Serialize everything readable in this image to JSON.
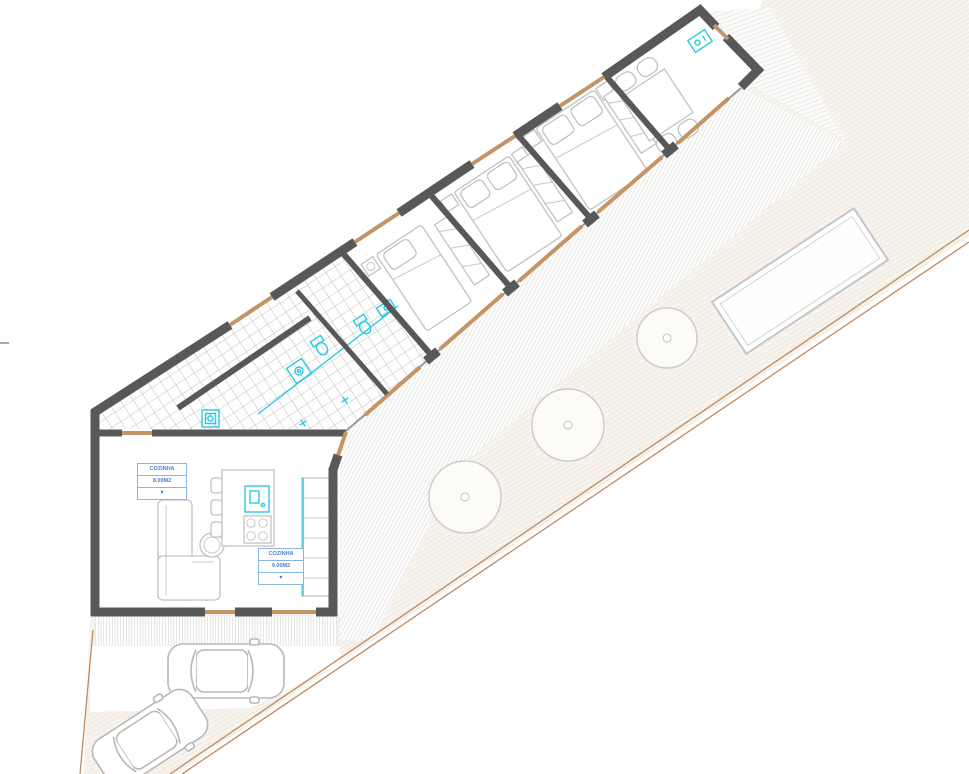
{
  "page": {
    "title": "Architectural site and floor plan"
  },
  "room_labels": {
    "label1": {
      "name": "COZINHA",
      "area": "8.00M2",
      "marker": "▼"
    },
    "label2": {
      "name": "COZINHA",
      "area": "9.00M2",
      "marker": "▼"
    }
  },
  "legend": {
    "wall_color": "#585858",
    "fixture_color": "#29cbe0",
    "threshold_color": "#c49465",
    "label_color": "#4a7fd0",
    "boundary_color": "#c08a5f"
  },
  "site": {
    "bedrooms": 3,
    "bathrooms": 2,
    "trees": 3,
    "cars": 2,
    "pool": true
  }
}
